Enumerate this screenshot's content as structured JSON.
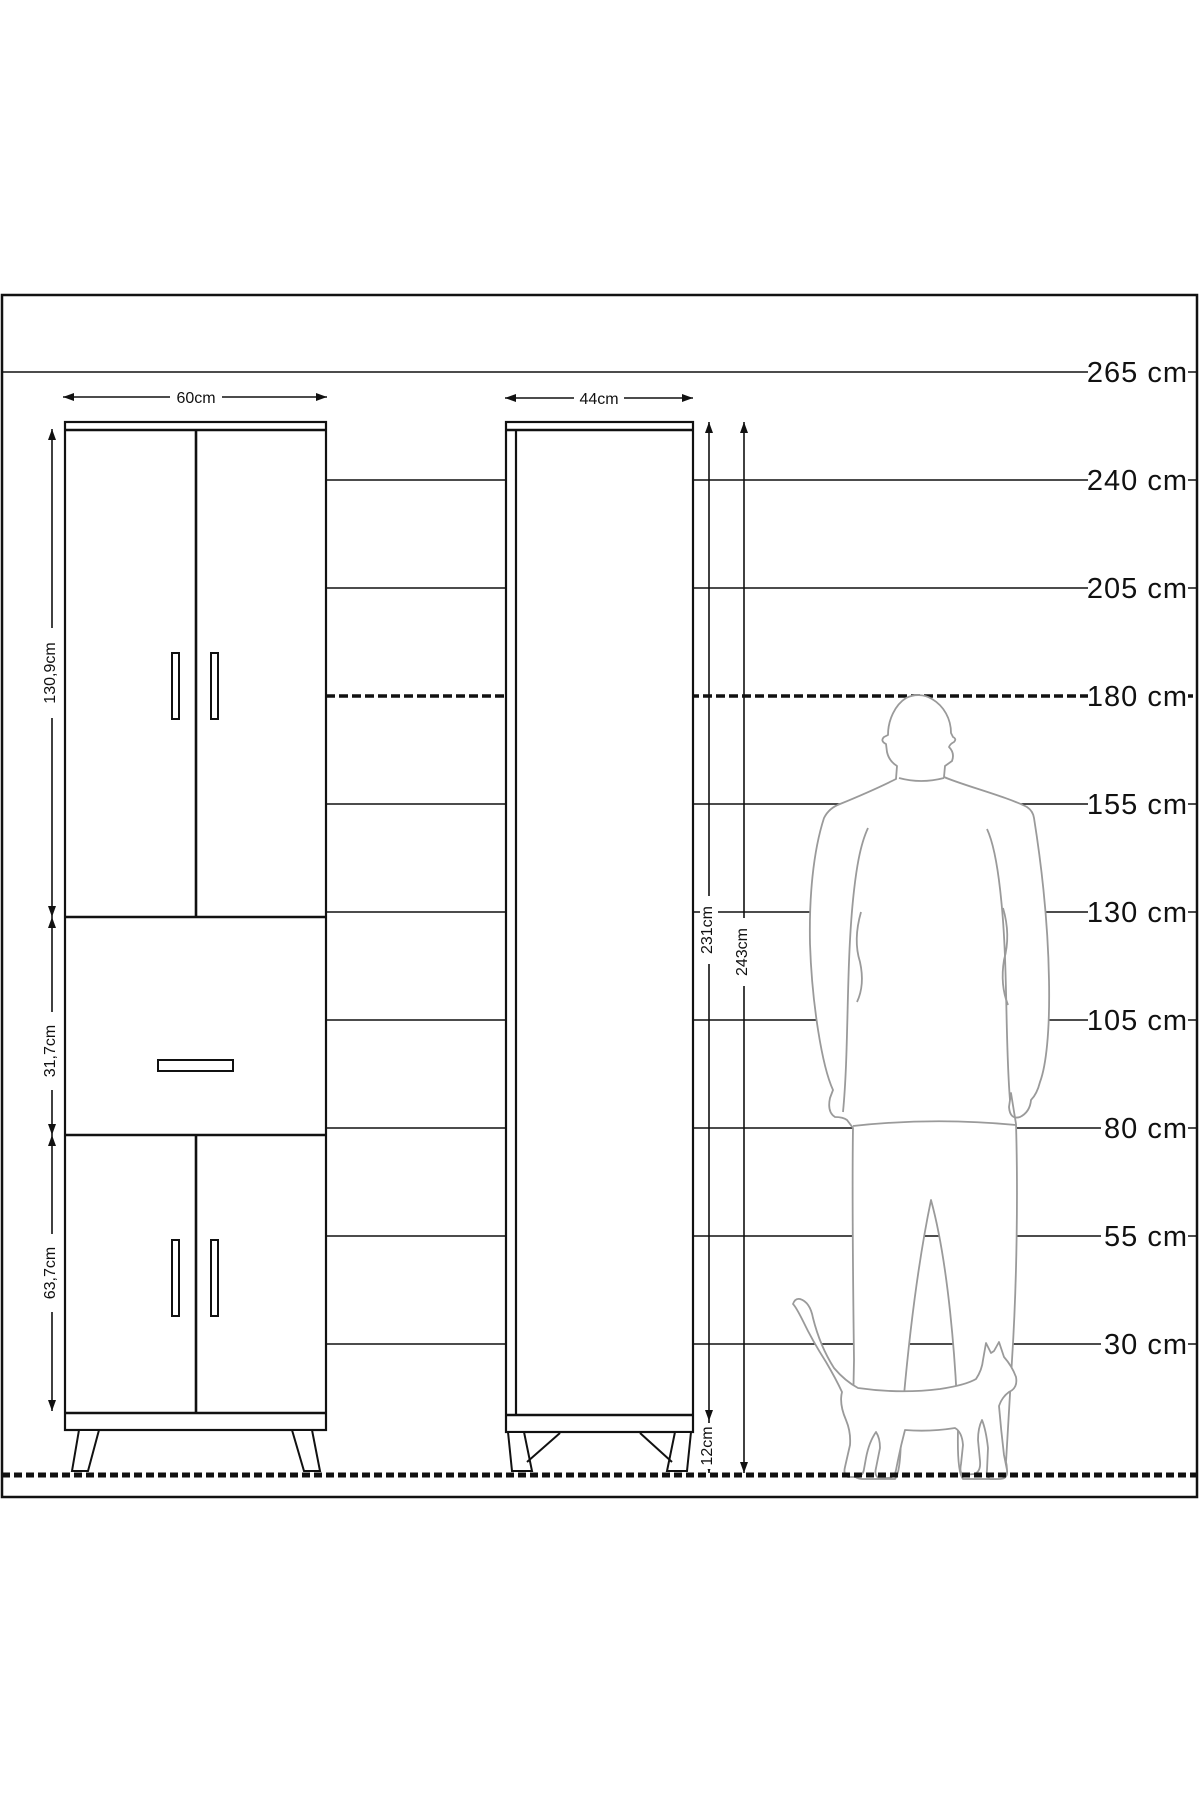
{
  "diagram": {
    "type": "furniture-dimension-drawing",
    "unit": "cm"
  },
  "scale": {
    "items": [
      {
        "label": "265 cm",
        "value": 265
      },
      {
        "label": "240 cm",
        "value": 240
      },
      {
        "label": "205 cm",
        "value": 205
      },
      {
        "label": "180 cm",
        "value": 180
      },
      {
        "label": "155 cm",
        "value": 155
      },
      {
        "label": "130 cm",
        "value": 130
      },
      {
        "label": "105 cm",
        "value": 105
      },
      {
        "label": "80 cm",
        "value": 80
      },
      {
        "label": "55 cm",
        "value": 55
      },
      {
        "label": "30 cm",
        "value": 30
      }
    ],
    "highlighted_level": "180 cm"
  },
  "cabinets": {
    "left": {
      "width_label": "60cm",
      "sections": {
        "top": "130,9cm",
        "middle": "31,7cm",
        "bottom": "63,7cm"
      }
    },
    "right": {
      "width_label": "44cm",
      "body_height_label": "231cm",
      "total_height_label": "243cm",
      "leg_height_label": "12cm"
    }
  }
}
